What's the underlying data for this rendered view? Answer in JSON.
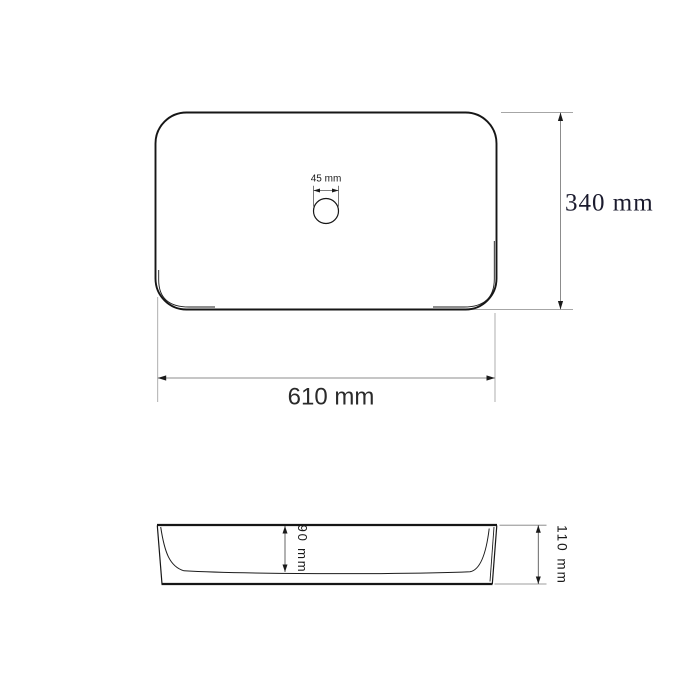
{
  "diagram": {
    "kind": "sink-technical-drawing",
    "unit": "mm",
    "top_view": {
      "drain_diameter": {
        "label": "45 mm",
        "value_mm": 45
      },
      "overall_length": {
        "label": "610 mm",
        "value_mm": 610
      },
      "overall_width": {
        "label": "340 mm",
        "value_mm": 340
      }
    },
    "side_view": {
      "inner_depth": {
        "label": "90 mm",
        "value_mm": 90
      },
      "overall_height": {
        "label": "110 mm",
        "value_mm": 110
      }
    },
    "colors": {
      "background": "#ffffff",
      "outline": "#161616",
      "dimension_line": "#8c8c8c",
      "extension_line": "#a6a6a6",
      "text": "#1a1a1a"
    }
  }
}
